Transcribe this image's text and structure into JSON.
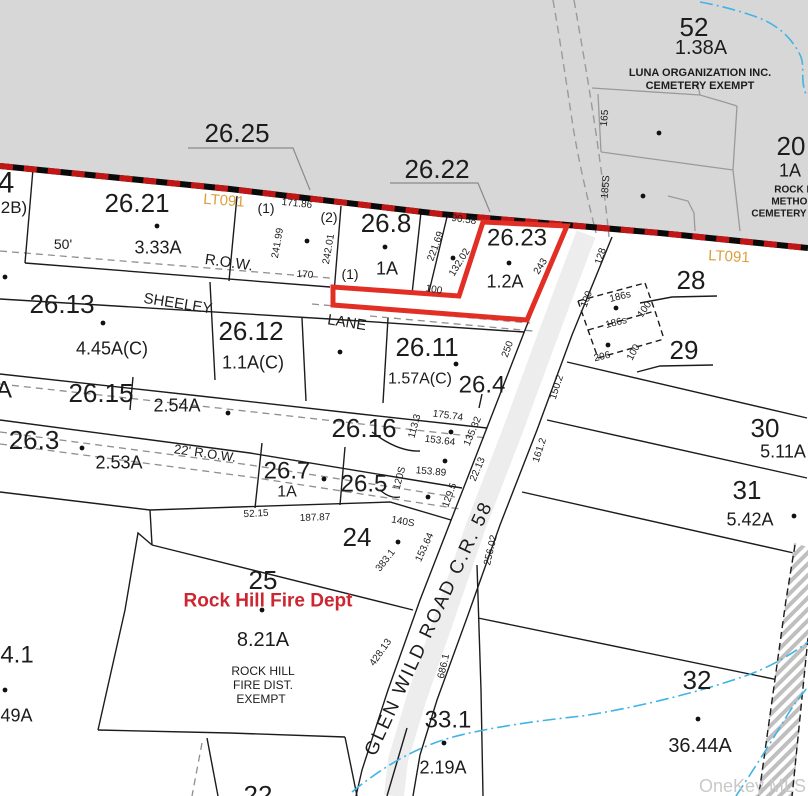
{
  "map": {
    "watermark": "OneKey MLS",
    "colors": {
      "highlight_red": "#e12f26",
      "boundary_red": "#c01616",
      "lt_gold": "#dd9f3e",
      "fire_dept_red": "#cc2631",
      "stream_blue": "#41b4e4",
      "gray_area": "#d7d7d7",
      "line_black": "#1c1c1c",
      "line_gray": "#8f8f8f",
      "watermark_gray": "#c9c9c9"
    },
    "labels": [
      {
        "n": "parcel-52-number",
        "t": "52",
        "x": 694,
        "y": 27,
        "s": 26
      },
      {
        "n": "parcel-52-acreage",
        "t": "1.38A",
        "x": 701,
        "y": 47,
        "s": 20
      },
      {
        "n": "parcel-52-owner-line1",
        "t": "LUNA ORGANIZATION INC.",
        "x": 700,
        "y": 72,
        "s": 11,
        "b": 1
      },
      {
        "n": "parcel-52-owner-line2",
        "t": "CEMETERY EXEMPT",
        "x": 700,
        "y": 85,
        "s": 11,
        "b": 1
      },
      {
        "n": "dim-165",
        "t": "165",
        "x": 604,
        "y": 118,
        "s": 10,
        "r": -85
      },
      {
        "n": "dim-185s",
        "t": "185S",
        "x": 605,
        "y": 187,
        "s": 10,
        "r": -85
      },
      {
        "n": "parcel-20-number",
        "t": "20",
        "x": 791,
        "y": 146,
        "s": 26
      },
      {
        "n": "parcel-20-acreage",
        "t": "1A",
        "x": 790,
        "y": 170,
        "s": 18
      },
      {
        "n": "parcel-20-owner-line1",
        "t": "ROCK H",
        "x": 794,
        "y": 189,
        "s": 10,
        "b": 1
      },
      {
        "n": "parcel-20-owner-line2",
        "t": "METHOD",
        "x": 793,
        "y": 201,
        "s": 10,
        "b": 1
      },
      {
        "n": "parcel-20-owner-line3",
        "t": "CEMETERY",
        "x": 779,
        "y": 213,
        "s": 10,
        "b": 1
      },
      {
        "n": "parcel-26-25-number",
        "t": "26.25",
        "x": 237,
        "y": 133,
        "s": 26
      },
      {
        "n": "parcel-26-22-number",
        "t": "26.22",
        "x": 437,
        "y": 169,
        "s": 26
      },
      {
        "n": "parcel-4-number",
        "t": "4",
        "x": 6,
        "y": 182,
        "s": 30
      },
      {
        "n": "parcel-2b-label",
        "t": "2B)",
        "x": 14,
        "y": 207,
        "s": 17
      },
      {
        "n": "parcel-26-21-number",
        "t": "26.21",
        "x": 137,
        "y": 203,
        "s": 26
      },
      {
        "n": "lt091-label-west",
        "t": "LT091",
        "x": 224,
        "y": 200,
        "s": 15,
        "r": 4,
        "c": "#dd9f3e"
      },
      {
        "n": "remnant-1-label",
        "t": "(1)",
        "x": 266,
        "y": 208,
        "s": 14
      },
      {
        "n": "dim-171-86",
        "t": "171.86",
        "x": 297,
        "y": 203,
        "s": 10,
        "r": 6
      },
      {
        "n": "remnant-2-label",
        "t": "(2)",
        "x": 329,
        "y": 217,
        "s": 14
      },
      {
        "n": "parcel-26-8-number",
        "t": "26.8",
        "x": 386,
        "y": 223,
        "s": 26
      },
      {
        "n": "dim-50ft",
        "t": "50'",
        "x": 63,
        "y": 244,
        "s": 14
      },
      {
        "n": "parcel-26-21-acreage",
        "t": "3.33A",
        "x": 158,
        "y": 247,
        "s": 18
      },
      {
        "n": "row-label-sheeley",
        "t": "R.O.W.",
        "x": 229,
        "y": 262,
        "s": 15,
        "r": 8
      },
      {
        "n": "dim-241-99",
        "t": "241.99",
        "x": 277,
        "y": 243,
        "s": 10,
        "r": -80
      },
      {
        "n": "dim-242-01",
        "t": "242.01",
        "x": 328,
        "y": 249,
        "s": 10,
        "r": -80
      },
      {
        "n": "dim-170",
        "t": "170",
        "x": 305,
        "y": 274,
        "s": 10,
        "r": 4
      },
      {
        "n": "remnant-1b-label",
        "t": "(1)",
        "x": 350,
        "y": 274,
        "s": 14
      },
      {
        "n": "parcel-26-8-acreage",
        "t": "1A",
        "x": 387,
        "y": 268,
        "s": 18
      },
      {
        "n": "dim-221-69",
        "t": "221.69",
        "x": 435,
        "y": 246,
        "s": 10,
        "r": -70
      },
      {
        "n": "dim-132-02",
        "t": "132.02",
        "x": 459,
        "y": 262,
        "s": 10,
        "r": -58
      },
      {
        "n": "dim-90-58",
        "t": "90.58",
        "x": 464,
        "y": 219,
        "s": 10,
        "r": 8
      },
      {
        "n": "parcel-26-23-number",
        "t": "26.23",
        "x": 517,
        "y": 237,
        "s": 24
      },
      {
        "n": "parcel-26-23-acreage",
        "t": "1.2A",
        "x": 505,
        "y": 281,
        "s": 18
      },
      {
        "n": "dim-243",
        "t": "243",
        "x": 540,
        "y": 266,
        "s": 10,
        "r": -58
      },
      {
        "n": "dim-100-a",
        "t": "100",
        "x": 434,
        "y": 289,
        "s": 10,
        "r": 10
      },
      {
        "n": "lt091-label-east",
        "t": "LT091",
        "x": 729,
        "y": 256,
        "s": 15,
        "r": 3,
        "c": "#dd9f3e"
      },
      {
        "n": "parcel-28-number",
        "t": "28",
        "x": 691,
        "y": 280,
        "s": 26
      },
      {
        "n": "parcel-29-number",
        "t": "29",
        "x": 684,
        "y": 350,
        "s": 26
      },
      {
        "n": "dim-128",
        "t": "128",
        "x": 600,
        "y": 256,
        "s": 10,
        "r": -72
      },
      {
        "n": "dim-186s-1",
        "t": "186s",
        "x": 620,
        "y": 296,
        "s": 10,
        "r": -14
      },
      {
        "n": "dim-186s-2",
        "t": "186s",
        "x": 616,
        "y": 322,
        "s": 10,
        "r": -14
      },
      {
        "n": "dim-100-b",
        "t": "100",
        "x": 644,
        "y": 309,
        "s": 10,
        "r": -55
      },
      {
        "n": "dim-100-c",
        "t": "100",
        "x": 586,
        "y": 299,
        "s": 10,
        "r": -70
      },
      {
        "n": "dim-206",
        "t": "206",
        "x": 602,
        "y": 356,
        "s": 10,
        "r": -14
      },
      {
        "n": "dim-100-d",
        "t": "100",
        "x": 633,
        "y": 352,
        "s": 10,
        "r": -62
      },
      {
        "n": "parcel-26-13-number",
        "t": "26.13",
        "x": 62,
        "y": 304,
        "s": 26
      },
      {
        "n": "road-name-sheeley",
        "t": "SHEELEY",
        "x": 178,
        "y": 303,
        "s": 15,
        "r": 9
      },
      {
        "n": "parcel-26-13-acreage",
        "t": "4.45A(C)",
        "x": 112,
        "y": 348,
        "s": 18
      },
      {
        "n": "parcel-26-12-number",
        "t": "26.12",
        "x": 251,
        "y": 331,
        "s": 26
      },
      {
        "n": "parcel-26-12-acreage",
        "t": "1.1A(C)",
        "x": 253,
        "y": 362,
        "s": 18
      },
      {
        "n": "road-name-lane",
        "t": "LANE",
        "x": 347,
        "y": 322,
        "s": 15,
        "r": 9
      },
      {
        "n": "parcel-26-11-number",
        "t": "26.11",
        "x": 427,
        "y": 347,
        "s": 26
      },
      {
        "n": "parcel-26-11-acreage",
        "t": "1.57A(C)",
        "x": 420,
        "y": 378,
        "s": 16
      },
      {
        "n": "parcel-26-4-number",
        "t": "26.4",
        "x": 482,
        "y": 384,
        "s": 24
      },
      {
        "n": "dim-250",
        "t": "250",
        "x": 507,
        "y": 349,
        "s": 10,
        "r": -70
      },
      {
        "n": "parcel-a-label",
        "t": "A",
        "x": 4,
        "y": 389,
        "s": 24
      },
      {
        "n": "parcel-26-15-number",
        "t": "26.15",
        "x": 101,
        "y": 393,
        "s": 26
      },
      {
        "n": "parcel-26-15-acreage",
        "t": "2.54A",
        "x": 177,
        "y": 405,
        "s": 18
      },
      {
        "n": "parcel-26-3-number",
        "t": "26.3",
        "x": 34,
        "y": 440,
        "s": 26
      },
      {
        "n": "parcel-26-3-acreage",
        "t": "2.53A",
        "x": 119,
        "y": 462,
        "s": 18
      },
      {
        "n": "row-label-22ft",
        "t": "22' R.O.W.",
        "x": 205,
        "y": 453,
        "s": 13,
        "r": 8
      },
      {
        "n": "parcel-26-16-number",
        "t": "26.16",
        "x": 364,
        "y": 428,
        "s": 26
      },
      {
        "n": "dim-113-3",
        "t": "113.3",
        "x": 414,
        "y": 426,
        "s": 10,
        "r": -75
      },
      {
        "n": "dim-175-74",
        "t": "175.74",
        "x": 448,
        "y": 415,
        "s": 10,
        "r": 8
      },
      {
        "n": "dim-153-64-a",
        "t": "153.64",
        "x": 440,
        "y": 440,
        "s": 10,
        "r": 7
      },
      {
        "n": "dim-135-32",
        "t": "135.32",
        "x": 472,
        "y": 431,
        "s": 10,
        "r": -67
      },
      {
        "n": "parcel-26-7-number",
        "t": "26.7",
        "x": 287,
        "y": 470,
        "s": 24
      },
      {
        "n": "parcel-26-7-acreage",
        "t": "1A",
        "x": 287,
        "y": 491,
        "s": 16
      },
      {
        "n": "parcel-26-5-number",
        "t": "26.5",
        "x": 364,
        "y": 483,
        "s": 24
      },
      {
        "n": "dim-120s",
        "t": "120S",
        "x": 399,
        "y": 478,
        "s": 10,
        "r": -75
      },
      {
        "n": "dim-153-89",
        "t": "153.89",
        "x": 431,
        "y": 471,
        "s": 10,
        "r": 5
      },
      {
        "n": "dim-129-5",
        "t": "129.5",
        "x": 449,
        "y": 495,
        "s": 10,
        "r": -70
      },
      {
        "n": "dim-22-13",
        "t": "22.13",
        "x": 477,
        "y": 469,
        "s": 10,
        "r": -67
      },
      {
        "n": "dim-52-15",
        "t": "52.15",
        "x": 256,
        "y": 513,
        "s": 10,
        "r": -3
      },
      {
        "n": "dim-187-87",
        "t": "187.87",
        "x": 315,
        "y": 517,
        "s": 10,
        "r": -2
      },
      {
        "n": "parcel-24-number",
        "t": "24",
        "x": 357,
        "y": 537,
        "s": 26
      },
      {
        "n": "dim-140s",
        "t": "140S",
        "x": 403,
        "y": 521,
        "s": 10,
        "r": 10
      },
      {
        "n": "dim-383-1",
        "t": "383.1",
        "x": 385,
        "y": 560,
        "s": 10,
        "r": -52
      },
      {
        "n": "dim-153-64-b",
        "t": "153.64",
        "x": 424,
        "y": 547,
        "s": 10,
        "r": -65
      },
      {
        "n": "parcel-30-number",
        "t": "30",
        "x": 765,
        "y": 428,
        "s": 26
      },
      {
        "n": "parcel-30-acreage",
        "t": "5.11A",
        "x": 783,
        "y": 451,
        "s": 18
      },
      {
        "n": "parcel-31-number",
        "t": "31",
        "x": 747,
        "y": 490,
        "s": 26
      },
      {
        "n": "parcel-31-acreage",
        "t": "5.42A",
        "x": 750,
        "y": 519,
        "s": 18
      },
      {
        "n": "parcel-25-number",
        "t": "25",
        "x": 263,
        "y": 580,
        "s": 26
      },
      {
        "n": "fire-dept-name",
        "t": "Rock Hill Fire Dept",
        "x": 268,
        "y": 600,
        "s": 19,
        "b": 1,
        "c": "#cc2631"
      },
      {
        "n": "parcel-25-acreage",
        "t": "8.21A",
        "x": 263,
        "y": 639,
        "s": 20
      },
      {
        "n": "parcel-25-owner-line1",
        "t": "ROCK HILL",
        "x": 263,
        "y": 671,
        "s": 12
      },
      {
        "n": "parcel-25-owner-line2",
        "t": "FIRE DIST.",
        "x": 263,
        "y": 685,
        "s": 12
      },
      {
        "n": "parcel-25-owner-line3",
        "t": "EXEMPT",
        "x": 261,
        "y": 699,
        "s": 12
      },
      {
        "n": "dim-428-13",
        "t": "428.13",
        "x": 380,
        "y": 652,
        "s": 10,
        "r": -55
      },
      {
        "n": "dim-686-1",
        "t": "686.1",
        "x": 443,
        "y": 666,
        "s": 10,
        "r": -77
      },
      {
        "n": "road-name-glen-wild",
        "t": "GLEN WILD ROAD C.R. 58",
        "x": 428,
        "y": 628,
        "s": 19,
        "r": -65,
        "ls": 2
      },
      {
        "n": "parcel-33-1-number",
        "t": "33.1",
        "x": 448,
        "y": 719,
        "s": 24
      },
      {
        "n": "parcel-33-1-acreage",
        "t": "2.19A",
        "x": 443,
        "y": 767,
        "s": 18
      },
      {
        "n": "dim-256-02",
        "t": "256.02",
        "x": 490,
        "y": 550,
        "s": 10,
        "r": -77
      },
      {
        "n": "dim-161-2",
        "t": "161.2",
        "x": 539,
        "y": 450,
        "s": 10,
        "r": -72
      },
      {
        "n": "dim-150-2",
        "t": "150.2",
        "x": 556,
        "y": 387,
        "s": 10,
        "r": -72
      },
      {
        "n": "parcel-32-number",
        "t": "32",
        "x": 697,
        "y": 680,
        "s": 26
      },
      {
        "n": "parcel-32-acreage",
        "t": "36.44A",
        "x": 700,
        "y": 745,
        "s": 20
      },
      {
        "n": "parcel-4-1-number",
        "t": "4.1",
        "x": 17,
        "y": 654,
        "s": 24
      },
      {
        "n": "parcel-4-1-acreage",
        "t": ".49A",
        "x": 14,
        "y": 715,
        "s": 18
      },
      {
        "n": "parcel-22-number",
        "t": "22",
        "x": 258,
        "y": 795,
        "s": 26
      }
    ],
    "dots": [
      [
        157,
        226
      ],
      [
        5,
        277
      ],
      [
        307,
        241
      ],
      [
        385,
        247
      ],
      [
        453,
        258
      ],
      [
        509,
        263
      ],
      [
        616,
        308
      ],
      [
        608,
        345
      ],
      [
        103,
        323
      ],
      [
        340,
        352
      ],
      [
        456,
        364
      ],
      [
        228,
        413
      ],
      [
        82,
        448
      ],
      [
        324,
        479
      ],
      [
        451,
        432
      ],
      [
        445,
        461
      ],
      [
        428,
        497
      ],
      [
        398,
        542
      ],
      [
        262,
        610
      ],
      [
        794,
        516
      ],
      [
        444,
        743
      ],
      [
        698,
        719
      ],
      [
        5,
        690
      ],
      [
        659,
        133
      ],
      [
        643,
        196
      ]
    ]
  }
}
